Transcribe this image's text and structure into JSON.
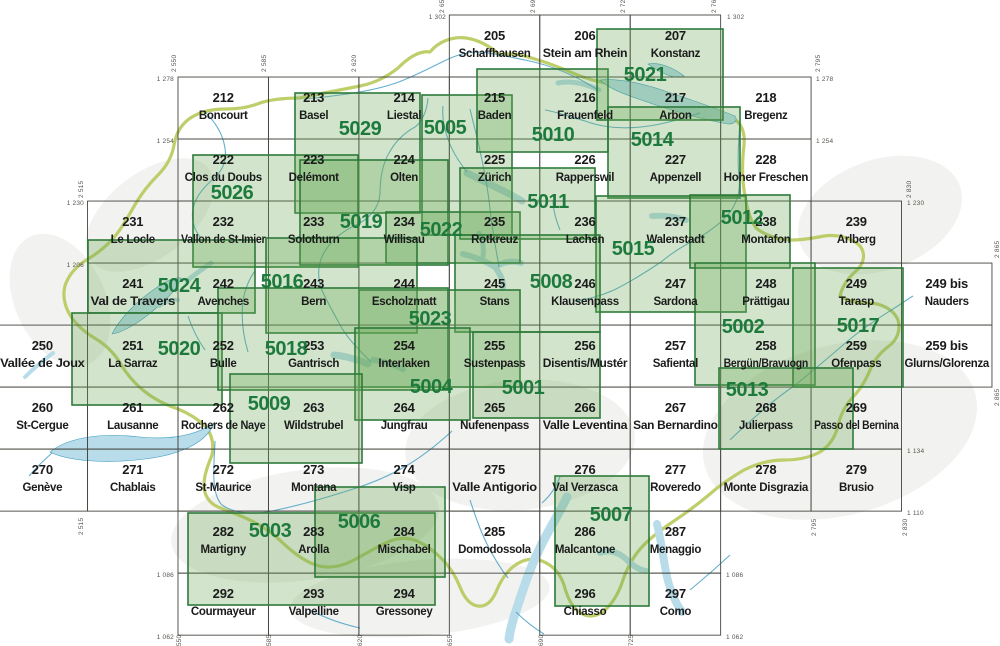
{
  "map_type": "swiss-map-sheet-index",
  "colors": {
    "background": "#ffffff",
    "terrain": "#e6e6e2",
    "grid": "#45453f",
    "sheet_label": "#1b1b1b",
    "overlay_fill": "#6aa855",
    "overlay_stroke": "#2d7a3a",
    "composite_label": "#1e7a3c",
    "water_fill": "#b8dcea",
    "water_line": "#3d9bc0",
    "country_border": "#b8c95a",
    "edge_label": "#55554f"
  },
  "geo": {
    "e0": 2550,
    "x0": 178,
    "n0": 1302,
    "y0": 15,
    "s": 2.584,
    "sheet_w_km": 35,
    "sheet_h_km": 24
  },
  "sheets": [
    {
      "num": "205",
      "name": "Schaffhausen",
      "e": 2655,
      "n": 1302
    },
    {
      "num": "206",
      "name": "Stein am Rhein",
      "e": 2690,
      "n": 1302
    },
    {
      "num": "207",
      "name": "Konstanz",
      "e": 2725,
      "n": 1302
    },
    {
      "num": "212",
      "name": "Boncourt",
      "e": 2550,
      "n": 1278
    },
    {
      "num": "213",
      "name": "Basel",
      "e": 2585,
      "n": 1278
    },
    {
      "num": "214",
      "name": "Liestal",
      "e": 2620,
      "n": 1278
    },
    {
      "num": "215",
      "name": "Baden",
      "e": 2655,
      "n": 1278
    },
    {
      "num": "216",
      "name": "Frauenfeld",
      "e": 2690,
      "n": 1278
    },
    {
      "num": "217",
      "name": "Arbon",
      "e": 2725,
      "n": 1278
    },
    {
      "num": "218",
      "name": "Bregenz",
      "e": 2760,
      "n": 1278
    },
    {
      "num": "222",
      "name": "Clos du Doubs",
      "e": 2550,
      "n": 1254
    },
    {
      "num": "223",
      "name": "Delémont",
      "e": 2585,
      "n": 1254
    },
    {
      "num": "224",
      "name": "Olten",
      "e": 2620,
      "n": 1254
    },
    {
      "num": "225",
      "name": "Zürich",
      "e": 2655,
      "n": 1254
    },
    {
      "num": "226",
      "name": "Rapperswil",
      "e": 2690,
      "n": 1254
    },
    {
      "num": "227",
      "name": "Appenzell",
      "e": 2725,
      "n": 1254
    },
    {
      "num": "228",
      "name": "Hoher Freschen",
      "e": 2760,
      "n": 1254
    },
    {
      "num": "231",
      "name": "Le Locle",
      "e": 2515,
      "n": 1230
    },
    {
      "num": "232",
      "name": "Vallon de St-Imier",
      "e": 2550,
      "n": 1230
    },
    {
      "num": "233",
      "name": "Solothurn",
      "e": 2585,
      "n": 1230
    },
    {
      "num": "234",
      "name": "Willisau",
      "e": 2620,
      "n": 1230
    },
    {
      "num": "235",
      "name": "Rotkreuz",
      "e": 2655,
      "n": 1230
    },
    {
      "num": "236",
      "name": "Lachen",
      "e": 2690,
      "n": 1230
    },
    {
      "num": "237",
      "name": "Walenstadt",
      "e": 2725,
      "n": 1230
    },
    {
      "num": "238",
      "name": "Montafon",
      "e": 2760,
      "n": 1230
    },
    {
      "num": "239",
      "name": "Arlberg",
      "e": 2795,
      "n": 1230
    },
    {
      "num": "241",
      "name": "Val de Travers",
      "e": 2515,
      "n": 1206
    },
    {
      "num": "242",
      "name": "Avenches",
      "e": 2550,
      "n": 1206
    },
    {
      "num": "243",
      "name": "Bern",
      "e": 2585,
      "n": 1206
    },
    {
      "num": "244",
      "name": "Escholzmatt",
      "e": 2620,
      "n": 1206
    },
    {
      "num": "245",
      "name": "Stans",
      "e": 2655,
      "n": 1206
    },
    {
      "num": "246",
      "name": "Klausenpass",
      "e": 2690,
      "n": 1206
    },
    {
      "num": "247",
      "name": "Sardona",
      "e": 2725,
      "n": 1206
    },
    {
      "num": "248",
      "name": "Prättigau",
      "e": 2760,
      "n": 1206
    },
    {
      "num": "249",
      "name": "Tarasp",
      "e": 2795,
      "n": 1206
    },
    {
      "num": "249 bis",
      "name": "Nauders",
      "e": 2830,
      "n": 1206
    },
    {
      "num": "250",
      "name": "Vallée de Joux",
      "e": 2480,
      "n": 1182
    },
    {
      "num": "251",
      "name": "La Sarraz",
      "e": 2515,
      "n": 1182
    },
    {
      "num": "252",
      "name": "Bulle",
      "e": 2550,
      "n": 1182
    },
    {
      "num": "253",
      "name": "Gantrisch",
      "e": 2585,
      "n": 1182
    },
    {
      "num": "254",
      "name": "Interlaken",
      "e": 2620,
      "n": 1182
    },
    {
      "num": "255",
      "name": "Sustenpass",
      "e": 2655,
      "n": 1182
    },
    {
      "num": "256",
      "name": "Disentis/Mustér",
      "e": 2690,
      "n": 1182
    },
    {
      "num": "257",
      "name": "Safiental",
      "e": 2725,
      "n": 1182
    },
    {
      "num": "258",
      "name": "Bergün/Bravuogn",
      "e": 2760,
      "n": 1182
    },
    {
      "num": "259",
      "name": "Ofenpass",
      "e": 2795,
      "n": 1182
    },
    {
      "num": "259 bis",
      "name": "Glurns/Glorenza",
      "e": 2830,
      "n": 1182
    },
    {
      "num": "260",
      "name": "St-Cergue",
      "e": 2480,
      "n": 1158
    },
    {
      "num": "261",
      "name": "Lausanne",
      "e": 2515,
      "n": 1158
    },
    {
      "num": "262",
      "name": "Rochers de Naye",
      "e": 2550,
      "n": 1158
    },
    {
      "num": "263",
      "name": "Wildstrubel",
      "e": 2585,
      "n": 1158
    },
    {
      "num": "264",
      "name": "Jungfrau",
      "e": 2620,
      "n": 1158
    },
    {
      "num": "265",
      "name": "Nufenenpass",
      "e": 2655,
      "n": 1158
    },
    {
      "num": "266",
      "name": "Valle Leventina",
      "e": 2690,
      "n": 1158
    },
    {
      "num": "267",
      "name": "San Bernardino",
      "e": 2725,
      "n": 1158
    },
    {
      "num": "268",
      "name": "Julierpass",
      "e": 2760,
      "n": 1158
    },
    {
      "num": "269",
      "name": "Passo del Bernina",
      "e": 2795,
      "n": 1158
    },
    {
      "num": "270",
      "name": "Genève",
      "e": 2480,
      "n": 1134
    },
    {
      "num": "271",
      "name": "Chablais",
      "e": 2515,
      "n": 1134
    },
    {
      "num": "272",
      "name": "St-Maurice",
      "e": 2550,
      "n": 1134
    },
    {
      "num": "273",
      "name": "Montana",
      "e": 2585,
      "n": 1134
    },
    {
      "num": "274",
      "name": "Visp",
      "e": 2620,
      "n": 1134
    },
    {
      "num": "275",
      "name": "Valle Antigorio",
      "e": 2655,
      "n": 1134
    },
    {
      "num": "276",
      "name": "Val Verzasca",
      "e": 2690,
      "n": 1134
    },
    {
      "num": "277",
      "name": "Roveredo",
      "e": 2725,
      "n": 1134
    },
    {
      "num": "278",
      "name": "Monte Disgrazia",
      "e": 2760,
      "n": 1134
    },
    {
      "num": "279",
      "name": "Brusio",
      "e": 2795,
      "n": 1134
    },
    {
      "num": "282",
      "name": "Martigny",
      "e": 2550,
      "n": 1110
    },
    {
      "num": "283",
      "name": "Arolla",
      "e": 2585,
      "n": 1110
    },
    {
      "num": "284",
      "name": "Mischabel",
      "e": 2620,
      "n": 1110
    },
    {
      "num": "285",
      "name": "Domodossola",
      "e": 2655,
      "n": 1110
    },
    {
      "num": "286",
      "name": "Malcantone",
      "e": 2690,
      "n": 1110
    },
    {
      "num": "287",
      "name": "Menaggio",
      "e": 2725,
      "n": 1110
    },
    {
      "num": "292",
      "name": "Courmayeur",
      "e": 2550,
      "n": 1086
    },
    {
      "num": "293",
      "name": "Valpelline",
      "e": 2585,
      "n": 1086
    },
    {
      "num": "294",
      "name": "Gressoney",
      "e": 2620,
      "n": 1086
    },
    {
      "num": "296",
      "name": "Chiasso",
      "e": 2690,
      "n": 1086
    },
    {
      "num": "297",
      "name": "Como",
      "e": 2725,
      "n": 1086
    }
  ],
  "composites": [
    {
      "num": "5029",
      "x": 295,
      "y": 93,
      "w": 125,
      "h": 120,
      "lx": 360,
      "ly": 128
    },
    {
      "num": "5005",
      "x": 422,
      "y": 95,
      "w": 90,
      "h": 140,
      "lx": 445,
      "ly": 127
    },
    {
      "num": "5010",
      "x": 477,
      "y": 69,
      "w": 131,
      "h": 83,
      "lx": 553,
      "ly": 134
    },
    {
      "num": "5021",
      "x": 597,
      "y": 29,
      "w": 126,
      "h": 91,
      "lx": 645,
      "ly": 74
    },
    {
      "num": "5014",
      "x": 608,
      "y": 107,
      "w": 132,
      "h": 91,
      "lx": 652,
      "ly": 139
    },
    {
      "num": "5026",
      "x": 193,
      "y": 155,
      "w": 165,
      "h": 112,
      "lx": 232,
      "ly": 192
    },
    {
      "num": "5019",
      "x": 300,
      "y": 160,
      "w": 148,
      "h": 105,
      "lx": 361,
      "ly": 221
    },
    {
      "num": "5022",
      "x": 386,
      "y": 212,
      "w": 134,
      "h": 51,
      "lx": 441,
      "ly": 229
    },
    {
      "num": "5011",
      "x": 460,
      "y": 168,
      "w": 135,
      "h": 71,
      "lx": 548,
      "ly": 201
    },
    {
      "num": "5015",
      "x": 596,
      "y": 196,
      "w": 150,
      "h": 116,
      "lx": 633,
      "ly": 248
    },
    {
      "num": "5012",
      "x": 690,
      "y": 195,
      "w": 100,
      "h": 73,
      "lx": 742,
      "ly": 217
    },
    {
      "num": "5024",
      "x": 88,
      "y": 240,
      "w": 167,
      "h": 73,
      "lx": 179,
      "ly": 285
    },
    {
      "num": "5016",
      "x": 266,
      "y": 238,
      "w": 151,
      "h": 95,
      "lx": 282,
      "ly": 281
    },
    {
      "num": "5008",
      "x": 455,
      "y": 235,
      "w": 145,
      "h": 97,
      "lx": 551,
      "ly": 281
    },
    {
      "num": "5023",
      "x": 359,
      "y": 290,
      "w": 161,
      "h": 97,
      "lx": 430,
      "ly": 318
    },
    {
      "num": "5002",
      "x": 695,
      "y": 263,
      "w": 120,
      "h": 122,
      "lx": 743,
      "ly": 326
    },
    {
      "num": "5017",
      "x": 793,
      "y": 268,
      "w": 110,
      "h": 119,
      "lx": 858,
      "ly": 325
    },
    {
      "num": "5020",
      "x": 72,
      "y": 313,
      "w": 150,
      "h": 92,
      "lx": 179,
      "ly": 348
    },
    {
      "num": "5018",
      "x": 218,
      "y": 288,
      "w": 230,
      "h": 102,
      "lx": 286,
      "ly": 348
    },
    {
      "num": "5004",
      "x": 355,
      "y": 328,
      "w": 115,
      "h": 92,
      "lx": 431,
      "ly": 386
    },
    {
      "num": "5001",
      "x": 473,
      "y": 332,
      "w": 127,
      "h": 86,
      "lx": 523,
      "ly": 387
    },
    {
      "num": "5013",
      "x": 719,
      "y": 368,
      "w": 134,
      "h": 81,
      "lx": 747,
      "ly": 389
    },
    {
      "num": "5009",
      "x": 230,
      "y": 374,
      "w": 132,
      "h": 89,
      "lx": 269,
      "ly": 403
    },
    {
      "num": "5003",
      "x": 188,
      "y": 513,
      "w": 247,
      "h": 92,
      "lx": 270,
      "ly": 530
    },
    {
      "num": "5006",
      "x": 315,
      "y": 487,
      "w": 130,
      "h": 90,
      "lx": 359,
      "ly": 521
    },
    {
      "num": "5007",
      "x": 555,
      "y": 476,
      "w": 94,
      "h": 130,
      "lx": 611,
      "ly": 514
    }
  ],
  "edge_labels": [
    {
      "t": "1 302",
      "x": 446,
      "y": 19,
      "a": "end",
      "r": 0
    },
    {
      "t": "1 302",
      "x": 727,
      "y": 19,
      "a": "start",
      "r": 0
    },
    {
      "t": "2 655",
      "x": 444,
      "y": 13,
      "a": "start",
      "r": 1
    },
    {
      "t": "2 690",
      "x": 535,
      "y": 13,
      "a": "start",
      "r": 1
    },
    {
      "t": "2 725",
      "x": 625,
      "y": 13,
      "a": "start",
      "r": 1
    },
    {
      "t": "2 760",
      "x": 716,
      "y": 13,
      "a": "start",
      "r": 1
    },
    {
      "t": "2 550",
      "x": 176,
      "y": 72,
      "a": "start",
      "r": 1
    },
    {
      "t": "2 585",
      "x": 266,
      "y": 72,
      "a": "start",
      "r": 1
    },
    {
      "t": "2 620",
      "x": 356,
      "y": 72,
      "a": "start",
      "r": 1
    },
    {
      "t": "2 515",
      "x": 83,
      "y": 198,
      "a": "start",
      "r": 1
    },
    {
      "t": "2 515",
      "x": 83,
      "y": 535,
      "a": "start",
      "r": 1
    },
    {
      "t": "1 278",
      "x": 174,
      "y": 81,
      "a": "end",
      "r": 0
    },
    {
      "t": "1 254",
      "x": 174,
      "y": 143,
      "a": "end",
      "r": 0
    },
    {
      "t": "1 230",
      "x": 84,
      "y": 205,
      "a": "end",
      "r": 0
    },
    {
      "t": "1 206",
      "x": 84,
      "y": 267,
      "a": "end",
      "r": 0
    },
    {
      "t": "1 086",
      "x": 174,
      "y": 577,
      "a": "end",
      "r": 0
    },
    {
      "t": "1 062",
      "x": 174,
      "y": 639,
      "a": "end",
      "r": 0
    },
    {
      "t": "2 795",
      "x": 820,
      "y": 72,
      "a": "start",
      "r": 1
    },
    {
      "t": "2 830",
      "x": 911,
      "y": 198,
      "a": "start",
      "r": 1
    },
    {
      "t": "2 865",
      "x": 999,
      "y": 258,
      "a": "start",
      "r": 1
    },
    {
      "t": "2 865",
      "x": 999,
      "y": 406,
      "a": "start",
      "r": 1
    },
    {
      "t": "2 795",
      "x": 816,
      "y": 536,
      "a": "start",
      "r": 1
    },
    {
      "t": "2 830",
      "x": 907,
      "y": 536,
      "a": "start",
      "r": 1
    },
    {
      "t": "1 278",
      "x": 816,
      "y": 81,
      "a": "start",
      "r": 0
    },
    {
      "t": "1 254",
      "x": 816,
      "y": 143,
      "a": "start",
      "r": 0
    },
    {
      "t": "1 230",
      "x": 907,
      "y": 205,
      "a": "start",
      "r": 0
    },
    {
      "t": "1 134",
      "x": 907,
      "y": 453,
      "a": "start",
      "r": 0
    },
    {
      "t": "1 110",
      "x": 907,
      "y": 515,
      "a": "start",
      "r": 0
    },
    {
      "t": "1 086",
      "x": 726,
      "y": 577,
      "a": "start",
      "r": 0
    },
    {
      "t": "1 062",
      "x": 726,
      "y": 639,
      "a": "start",
      "r": 0
    },
    {
      "t": "2 550",
      "x": 181,
      "y": 652,
      "a": "start",
      "r": 1
    },
    {
      "t": "2 585",
      "x": 271,
      "y": 652,
      "a": "start",
      "r": 1
    },
    {
      "t": "2 620",
      "x": 362,
      "y": 652,
      "a": "start",
      "r": 1
    },
    {
      "t": "2 655",
      "x": 452,
      "y": 652,
      "a": "start",
      "r": 1
    },
    {
      "t": "2 690",
      "x": 543,
      "y": 652,
      "a": "start",
      "r": 1
    },
    {
      "t": "2 725",
      "x": 633,
      "y": 652,
      "a": "start",
      "r": 1
    }
  ]
}
